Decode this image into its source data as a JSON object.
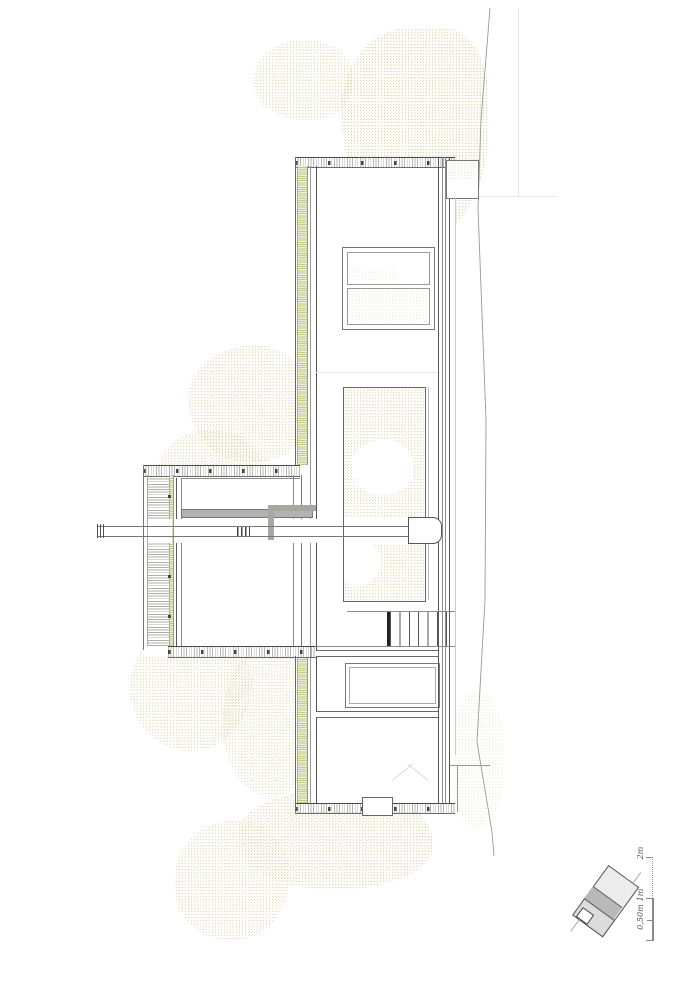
{
  "drawing": {
    "kind_note": "architectural floor plan, line drawing, no title text visible"
  },
  "scale_bar": {
    "label_2m": "2m",
    "label_1m": "1m",
    "label_0_50m": "0,50m"
  },
  "colors": {
    "background": "#ffffff",
    "vegetation_dots": "#e3d9b6",
    "planted_strip_green": "#c3c983",
    "wall_lines": "#555555",
    "boundary_line": "#9a9a9a",
    "keyplan_shade_light": "#ececec",
    "keyplan_shade_dark": "#b9b9b9"
  }
}
